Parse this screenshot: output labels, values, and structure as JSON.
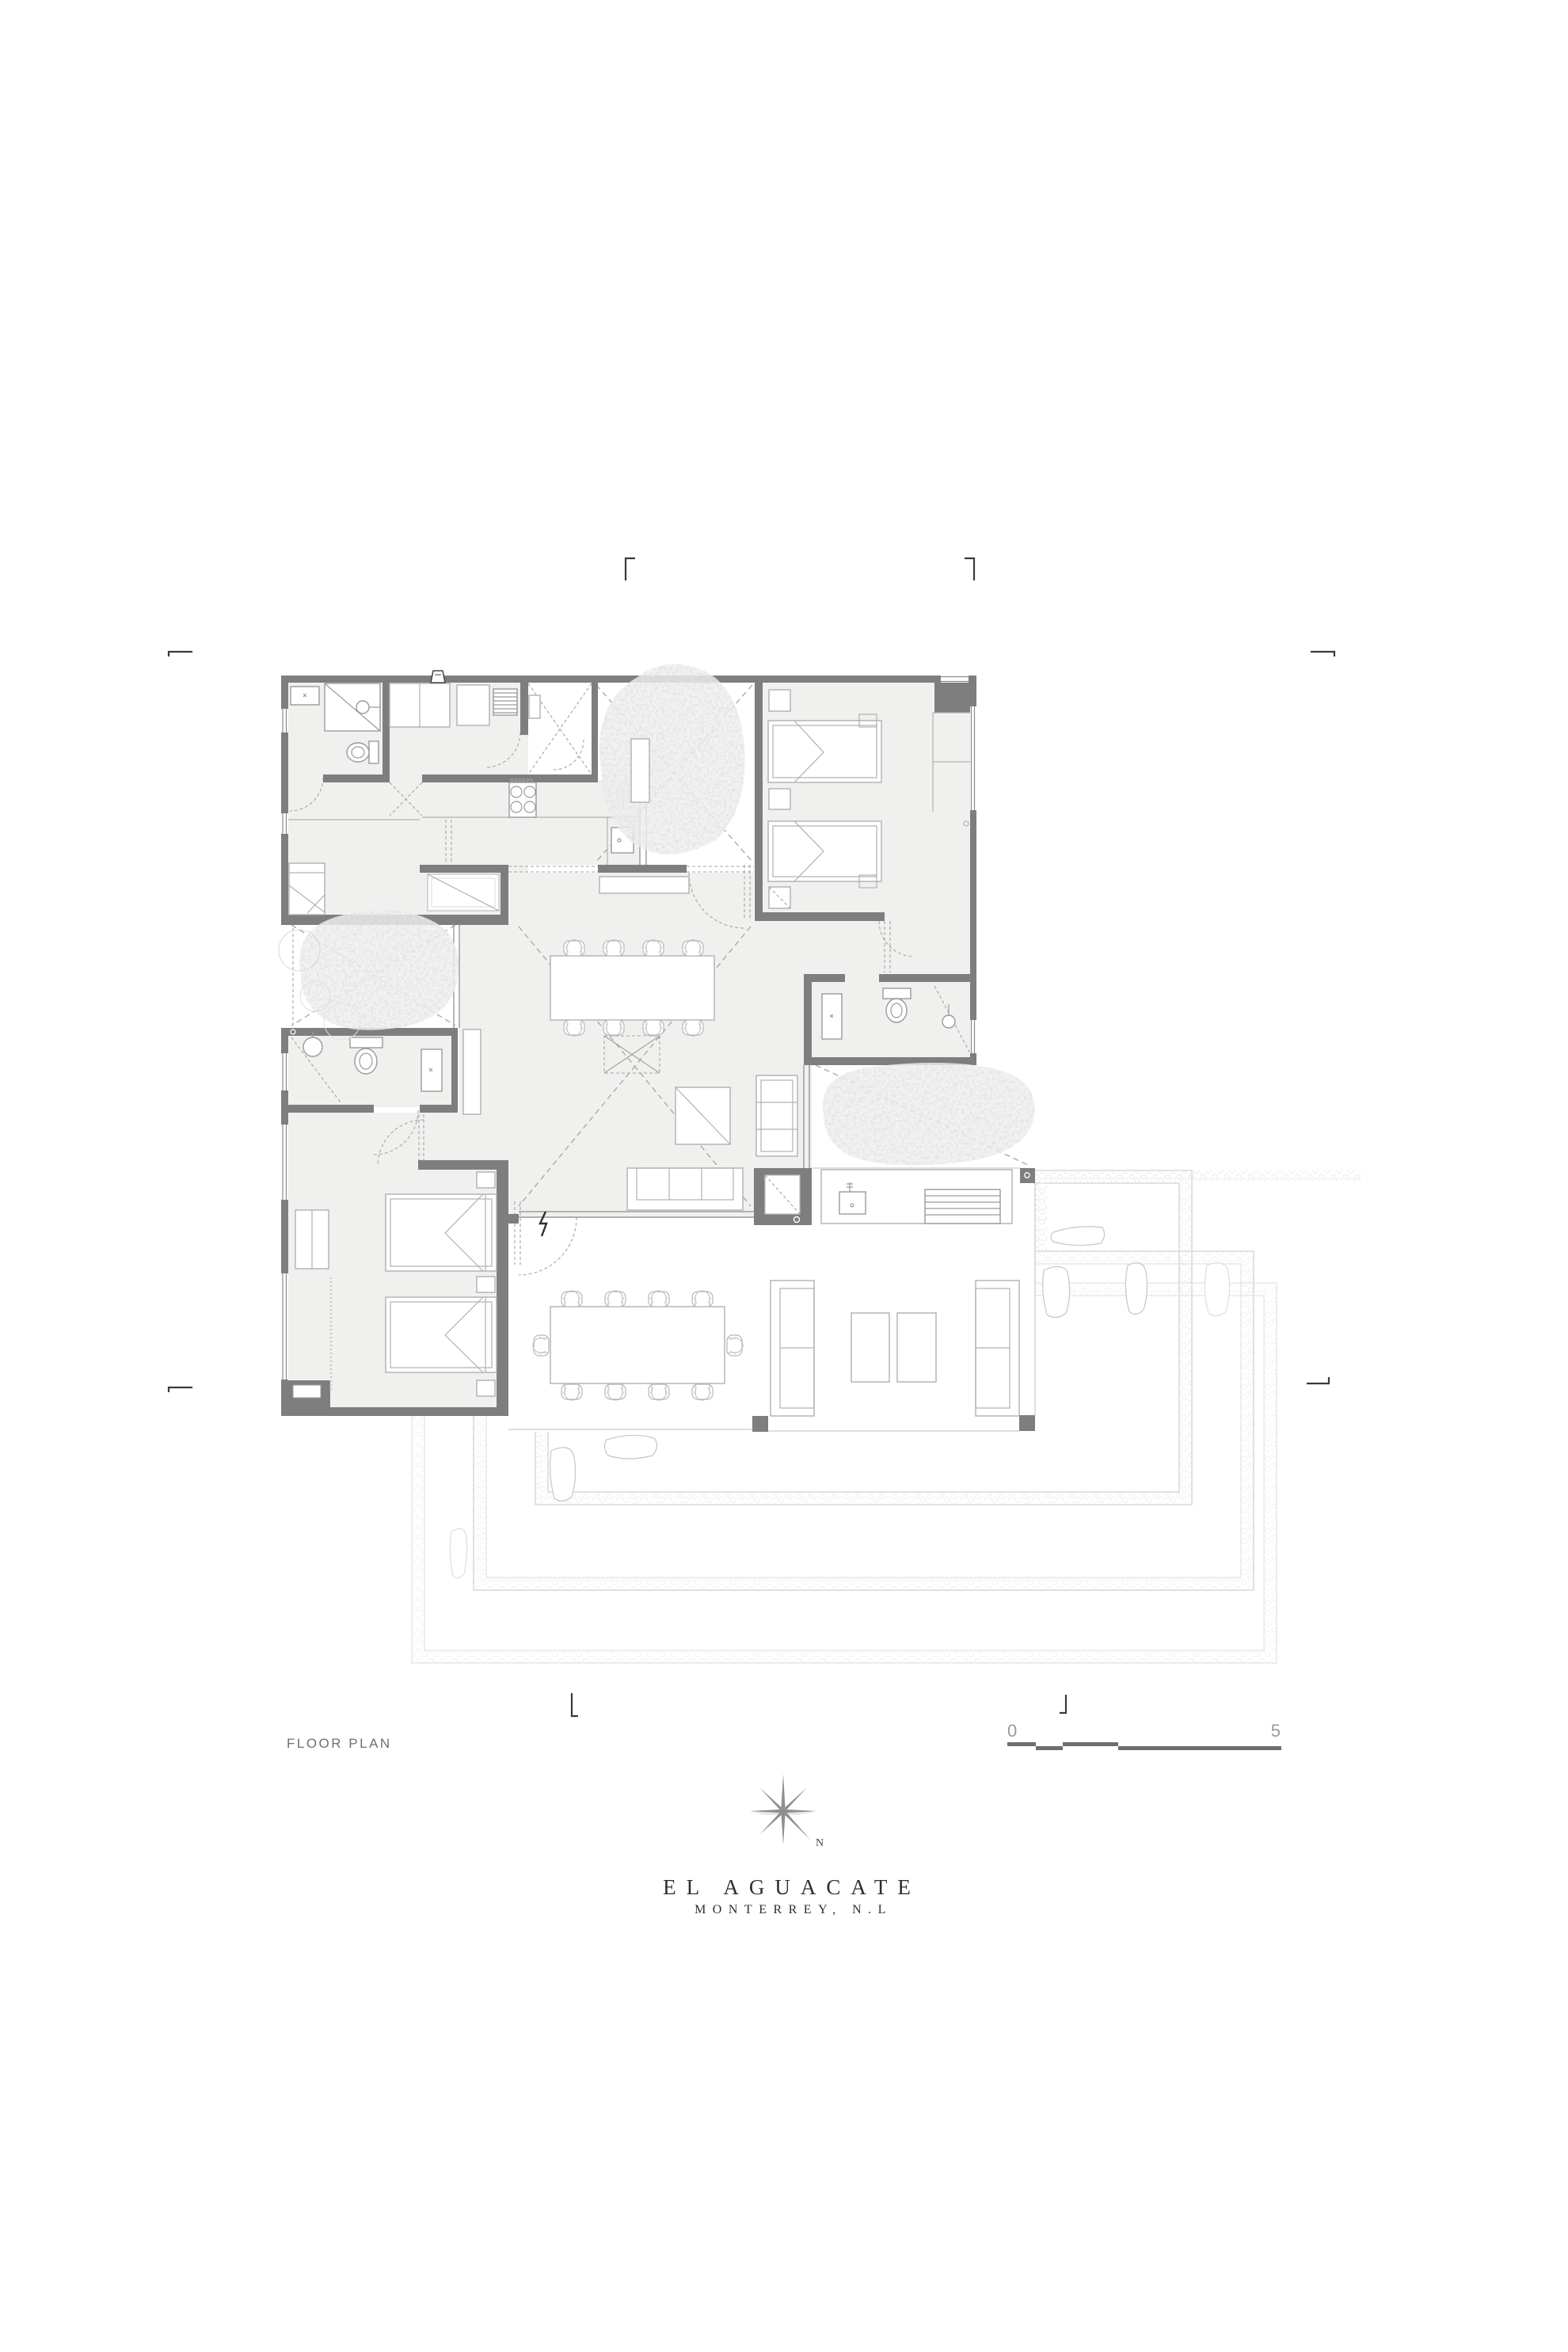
{
  "title_block": {
    "project": "EL AGUACATE",
    "location": "MONTERREY, N.L",
    "drawing_label": "FLOOR PLAN"
  },
  "scale_bar": {
    "start": "0",
    "end": "5"
  },
  "compass": {
    "label": "N"
  },
  "colors": {
    "wall": "#7e7e7e",
    "floor": "#f0f0ee",
    "furniture_line": "#b0b0b0",
    "dashed_line": "#a5a5a5",
    "ghost_deck": "#d6d6d6",
    "title_text": "#2e2e2e",
    "label_text": "#6f6f6f",
    "scale_number": "#9a9a9a",
    "scale_bar": "#6e6e6e"
  }
}
